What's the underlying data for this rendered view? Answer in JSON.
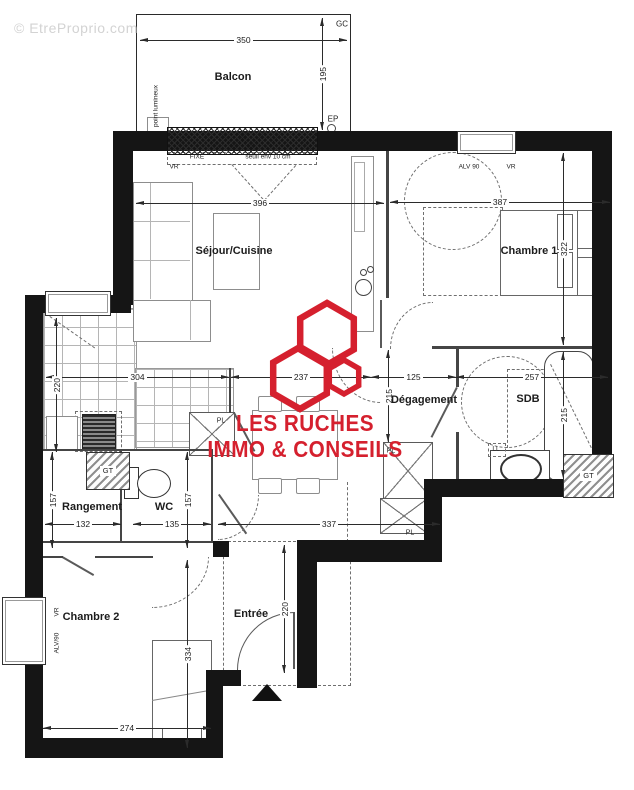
{
  "watermark": "© EtreProprio.com",
  "logo": {
    "line1": "LES RUCHES",
    "line2": "IMMO & CONSEILS",
    "color": "#d5202e"
  },
  "rooms": {
    "balcon": "Balcon",
    "sejour": "Séjour/Cuisine",
    "chambre1": "Chambre 1",
    "degagement": "Dégagement",
    "sdb": "SDB",
    "rangement": "Rangement",
    "wc": "WC",
    "chambre2": "Chambre 2",
    "entree": "Entrée"
  },
  "dims": {
    "d350": "350",
    "d195": "195",
    "d396": "396",
    "d387": "387",
    "d322": "322",
    "d304": "304",
    "d237": "237",
    "d125": "125",
    "d257": "257",
    "d220": "220",
    "d215": "215",
    "d157": "157",
    "d132": "132",
    "d135": "135",
    "d337": "337",
    "d274": "274",
    "d334": "334"
  },
  "annotations": {
    "gc": "GC",
    "ep": "EP",
    "fixe": "FIXE",
    "seuil": "seuil env 10 cm",
    "vr": "VR",
    "alv90": "ALV 90",
    "alv90b": "ALV/90",
    "pl": "PL",
    "gt": "GT",
    "ll": "LL",
    "point_lumineux": "point lumineux"
  },
  "colors": {
    "wall": "#151515",
    "logo_red": "#d5202e",
    "watermark_gray": "#d3d3d3"
  }
}
